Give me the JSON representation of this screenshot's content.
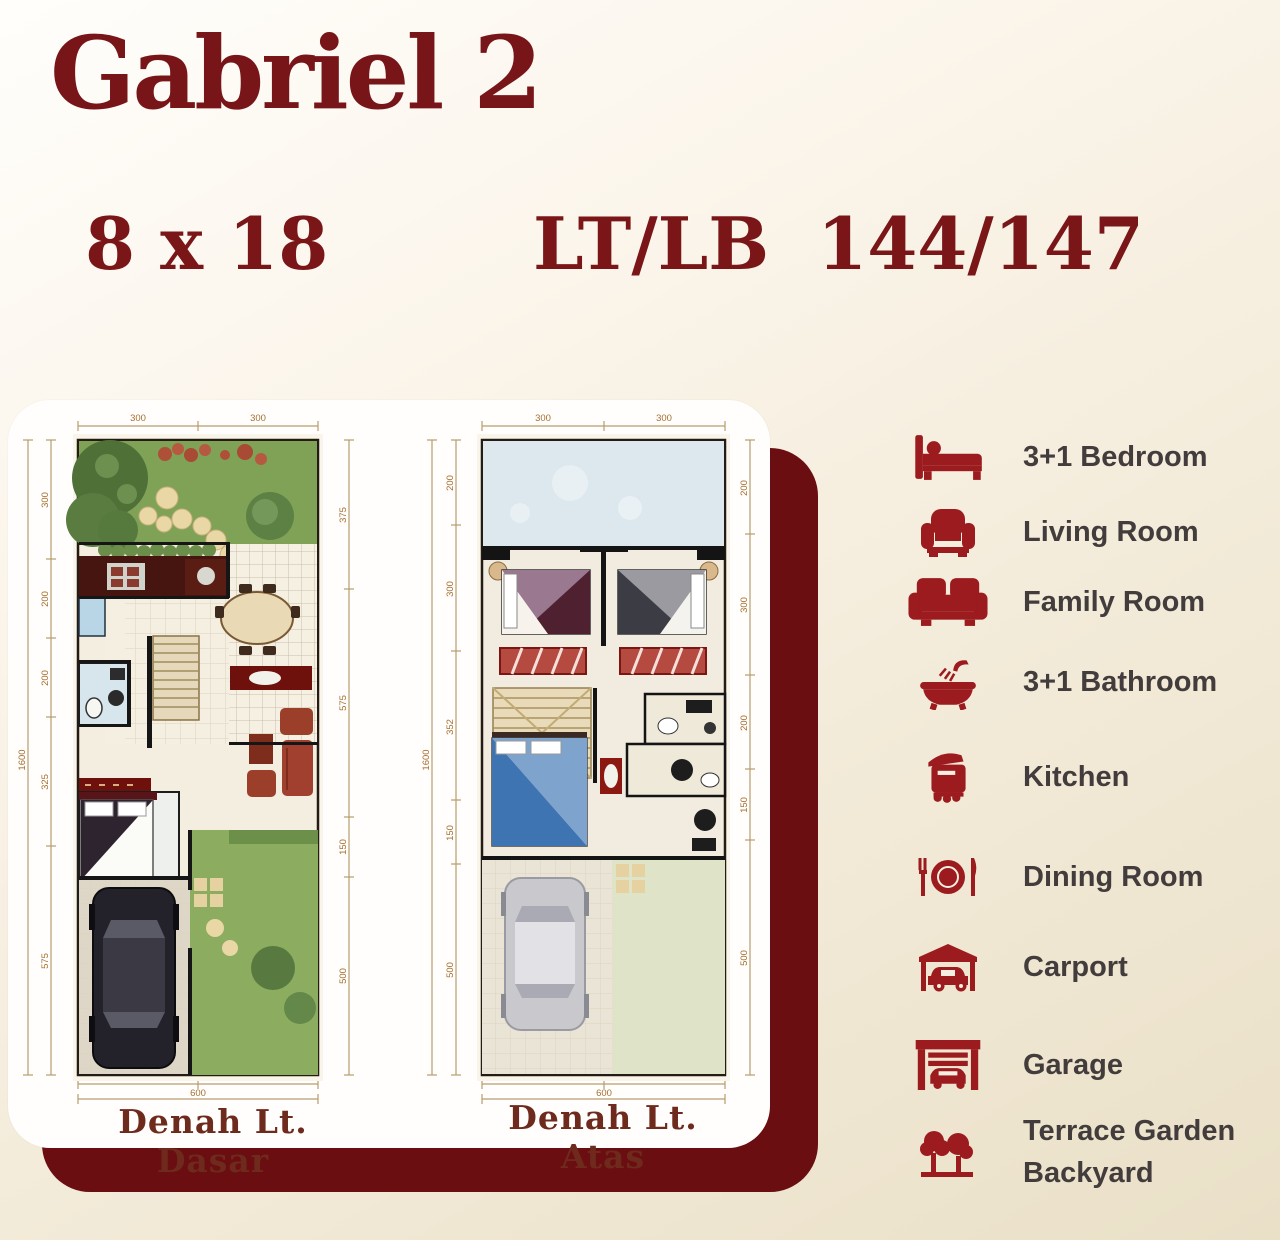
{
  "header": {
    "title": "Gabriel 2",
    "size": "8 x 18",
    "lt_label": "LT/LB",
    "lt_value": "144/147"
  },
  "plans": {
    "ground": {
      "caption": "Denah Lt. Dasar",
      "dims": {
        "top": [
          "300",
          "300"
        ],
        "left_total": "1600",
        "left": [
          "300",
          "200",
          "200",
          "325",
          "575"
        ],
        "right": [
          "375",
          "575",
          "150",
          "500"
        ],
        "bottom": [
          "300",
          "300"
        ],
        "bottom_total": "600"
      }
    },
    "upper": {
      "caption": "Denah Lt. Atas",
      "dims": {
        "top": [
          "300",
          "300"
        ],
        "left_total": "1600",
        "left": [
          "200",
          "300",
          "352",
          "150",
          "500"
        ],
        "right": [
          "200",
          "300",
          "200",
          "150",
          "500"
        ],
        "bottom": [
          "300",
          "300"
        ],
        "bottom_total": "600"
      }
    }
  },
  "legend": {
    "items": [
      {
        "icon": "bed-icon",
        "label": "3+1 Bedroom"
      },
      {
        "icon": "armchair-icon",
        "label": "Living Room"
      },
      {
        "icon": "sofa-icon",
        "label": "Family Room"
      },
      {
        "icon": "bathtub-icon",
        "label": "3+1 Bathroom"
      },
      {
        "icon": "rice-cooker-icon",
        "label": "Kitchen"
      },
      {
        "icon": "plate-cutlery-icon",
        "label": "Dining Room"
      },
      {
        "icon": "carport-icon",
        "label": "Carport"
      },
      {
        "icon": "garage-icon",
        "label": "Garage"
      },
      {
        "icon": "trees-icon",
        "label": "Terrace Garden",
        "label2": "Backyard"
      }
    ]
  },
  "colors": {
    "maroon_title": "#771518",
    "icon_red": "#9c1b1f",
    "legend_text": "#423d3c",
    "card_shadow": "#6b0e12",
    "garden_green": "#7fa257",
    "roof_blue": "#dce7ee"
  }
}
